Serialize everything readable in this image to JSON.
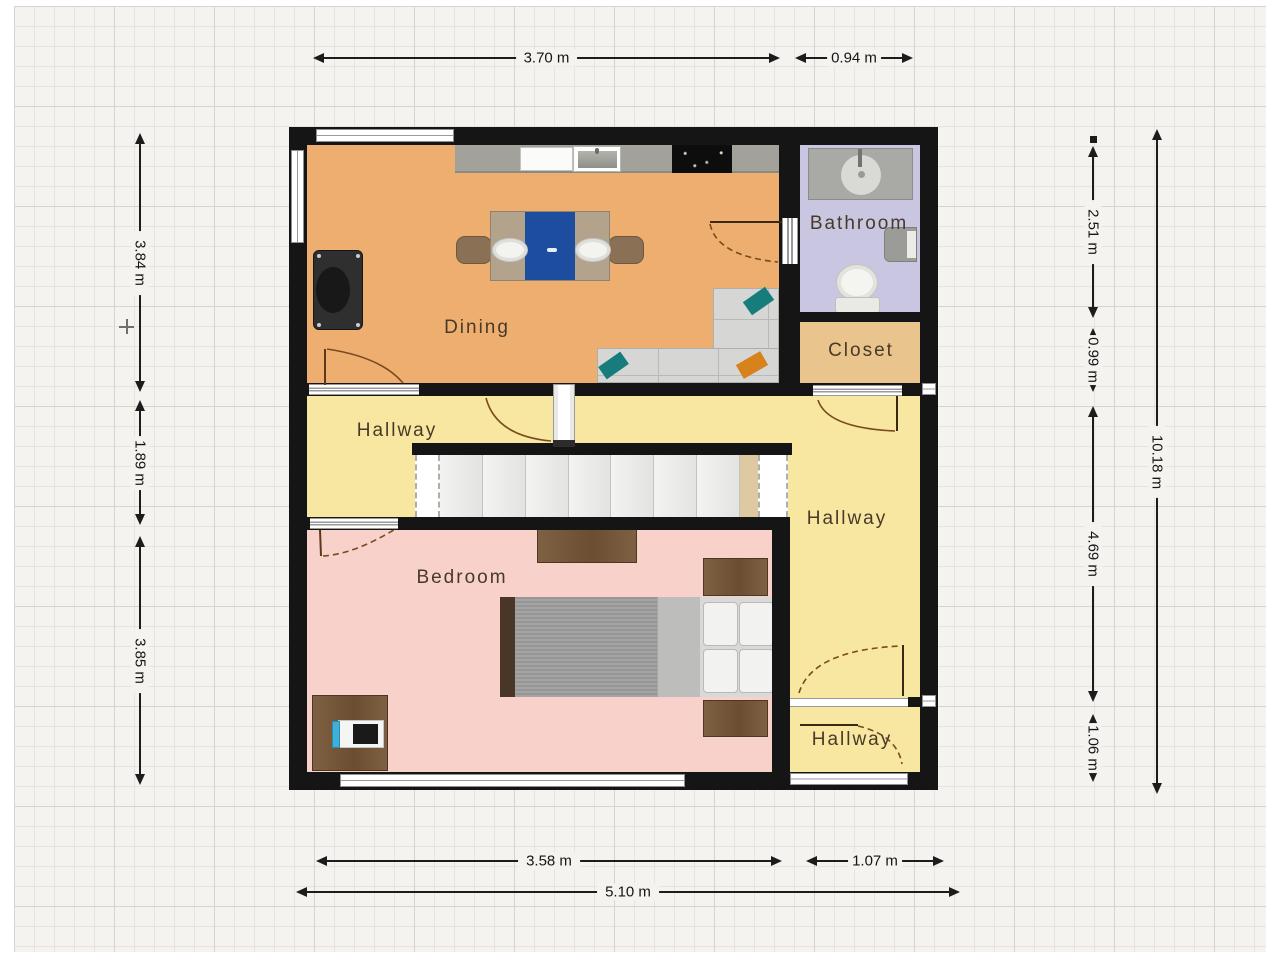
{
  "app": {
    "type": "floorplan-view",
    "background": "grid-paper"
  },
  "rooms": {
    "dining": {
      "label": "Dining"
    },
    "bathroom": {
      "label": "Bathroom"
    },
    "closet": {
      "label": "Closet"
    },
    "hallway_left": {
      "label": "Hallway"
    },
    "hallway_right": {
      "label": "Hallway"
    },
    "hallway_bottom": {
      "label": "Hallway"
    },
    "bedroom": {
      "label": "Bedroom"
    }
  },
  "dimensions": {
    "top_main": "3.70 m",
    "top_side": "0.94 m",
    "left_top": "3.84 m",
    "left_middle": "1.89 m",
    "left_bottom": "3.85 m",
    "right_bathroom": "2.51 m",
    "right_closet": "0.99 m",
    "right_hallway": "4.69 m",
    "right_entry": "1.06 m",
    "right_total": "10.18 m",
    "bottom_main": "3.58 m",
    "bottom_side": "1.07 m",
    "bottom_total": "5.10 m"
  },
  "palette": {
    "wall": "#151515",
    "dining_floor": "#eeae70",
    "hallway_floor": "#f8e7a1",
    "bedroom_floor": "#f7d1ca",
    "bathroom_floor": "#c8c6e0",
    "closet_floor": "#e9c48c",
    "counter_gray": "#a2a29a",
    "table_runner_blue": "#1d4d9f",
    "pillow_teal": "#177c7c",
    "pillow_orange": "#d8821c",
    "wood_brown": "#7a5c3f",
    "door_arc_brown": "#7a4a1f"
  },
  "furniture_icons": [
    "kitchen-counter",
    "kitchen-cabinet",
    "kitchen-sink",
    "stove",
    "dining-table",
    "dining-chair",
    "piano",
    "sectional-sofa",
    "throw-pillow",
    "shower",
    "wall-sink",
    "toilet",
    "staircase",
    "bed",
    "pillow",
    "nightstand",
    "dresser",
    "desk",
    "computer"
  ]
}
